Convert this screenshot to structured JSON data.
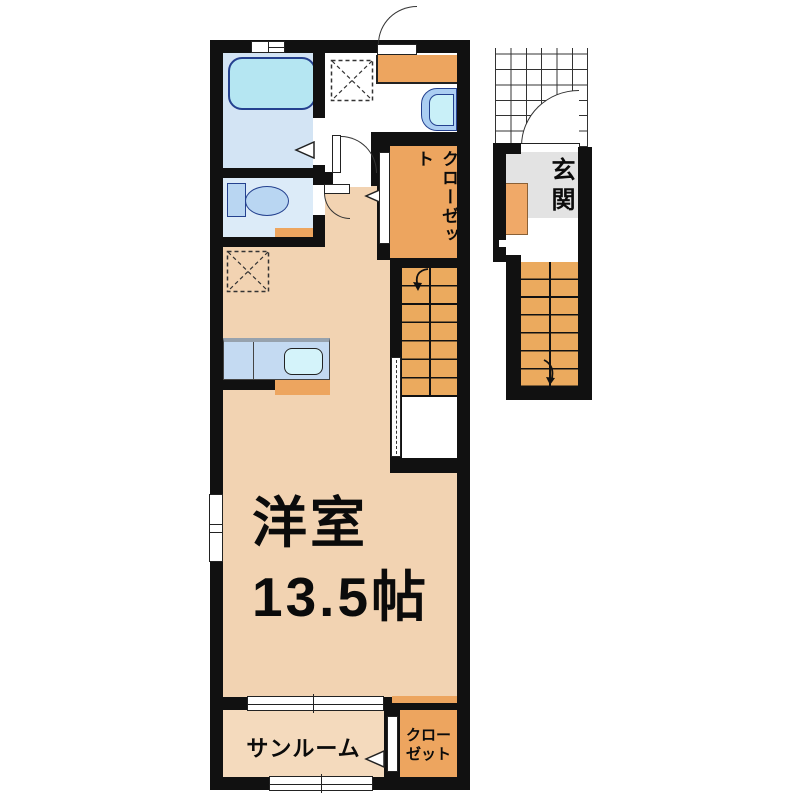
{
  "plan": {
    "type": "apartment-floor-plan",
    "labels": {
      "main_room_name": "洋室",
      "main_room_size": "13.5帖",
      "closet_upper": "クローゼット",
      "entrance": "玄関",
      "sunroom": "サンルーム",
      "closet_lower_line1": "クロー",
      "closet_lower_line2": "ゼット"
    },
    "colors": {
      "wall": "#111111",
      "main_room_floor": "#f2d3b2",
      "sunroom_floor": "#f4dabd",
      "closet_orange": "#eda55f",
      "stair_orange": "#ebaa5e",
      "shoe_cabinet_orange": "#f0a968",
      "entrance_floor_gray": "#e3e3e3",
      "bathroom_floor": "#d3e4f4",
      "toilet_floor": "#dcebf8",
      "bathtub_fill": "#b5e6f2",
      "fixture_fill": "#b9d6f2",
      "sink_fill": "#d4f3fa",
      "kitchen_counter": "#c4daf2",
      "fixture_outline": "#24418f"
    },
    "fixtures": [
      "bathtub",
      "toilet",
      "washbasin",
      "washing-machine-pan",
      "floor-pan",
      "kitchen-counter",
      "kitchen-sink",
      "shoe-cabinet",
      "interior-staircase",
      "entrance-staircase",
      "entrance-porch-grid"
    ]
  }
}
